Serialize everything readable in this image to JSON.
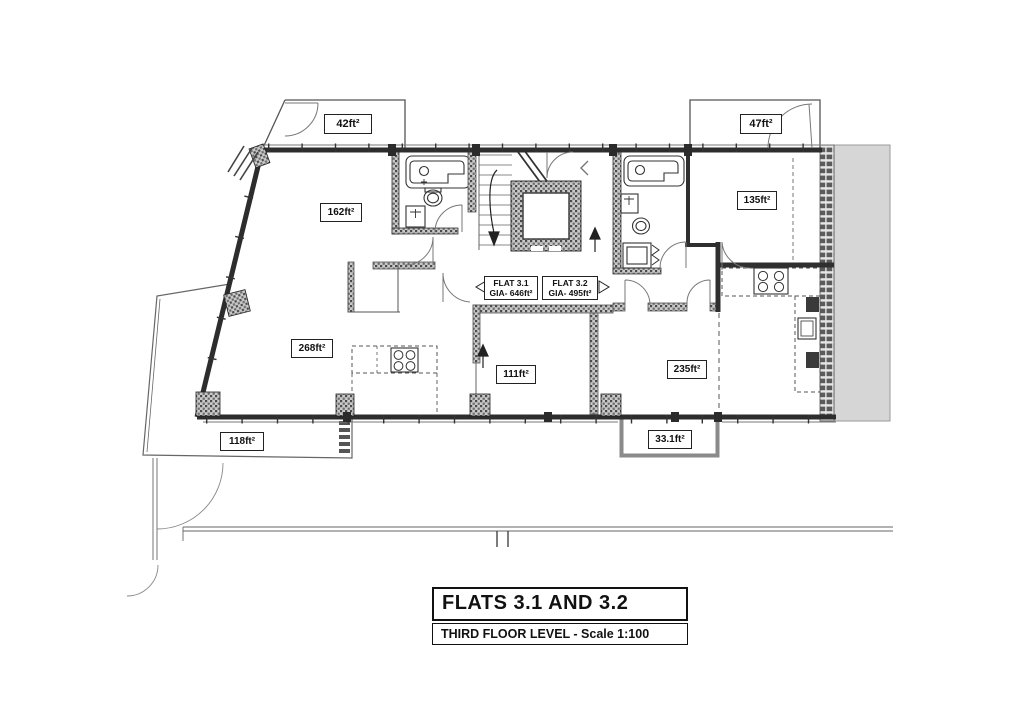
{
  "drawing": {
    "areas": {
      "terrace_top_left": "42ft²",
      "room_162": "162ft²",
      "room_268": "268ft²",
      "terrace_118": "118ft²",
      "room_111": "111ft²",
      "room_235": "235ft²",
      "balcony_331": "33.1ft²",
      "room_135": "135ft²",
      "terrace_47": "47ft²"
    },
    "flats": {
      "flat31": {
        "name": "FLAT 3.1",
        "gia": "GIA- 646ft²"
      },
      "flat32": {
        "name": "FLAT 3.2",
        "gia": "GIA- 495ft²"
      }
    },
    "title_block": {
      "title": "FLATS 3.1 AND 3.2",
      "subtitle": "THIRD FLOOR LEVEL - Scale 1:100"
    }
  }
}
